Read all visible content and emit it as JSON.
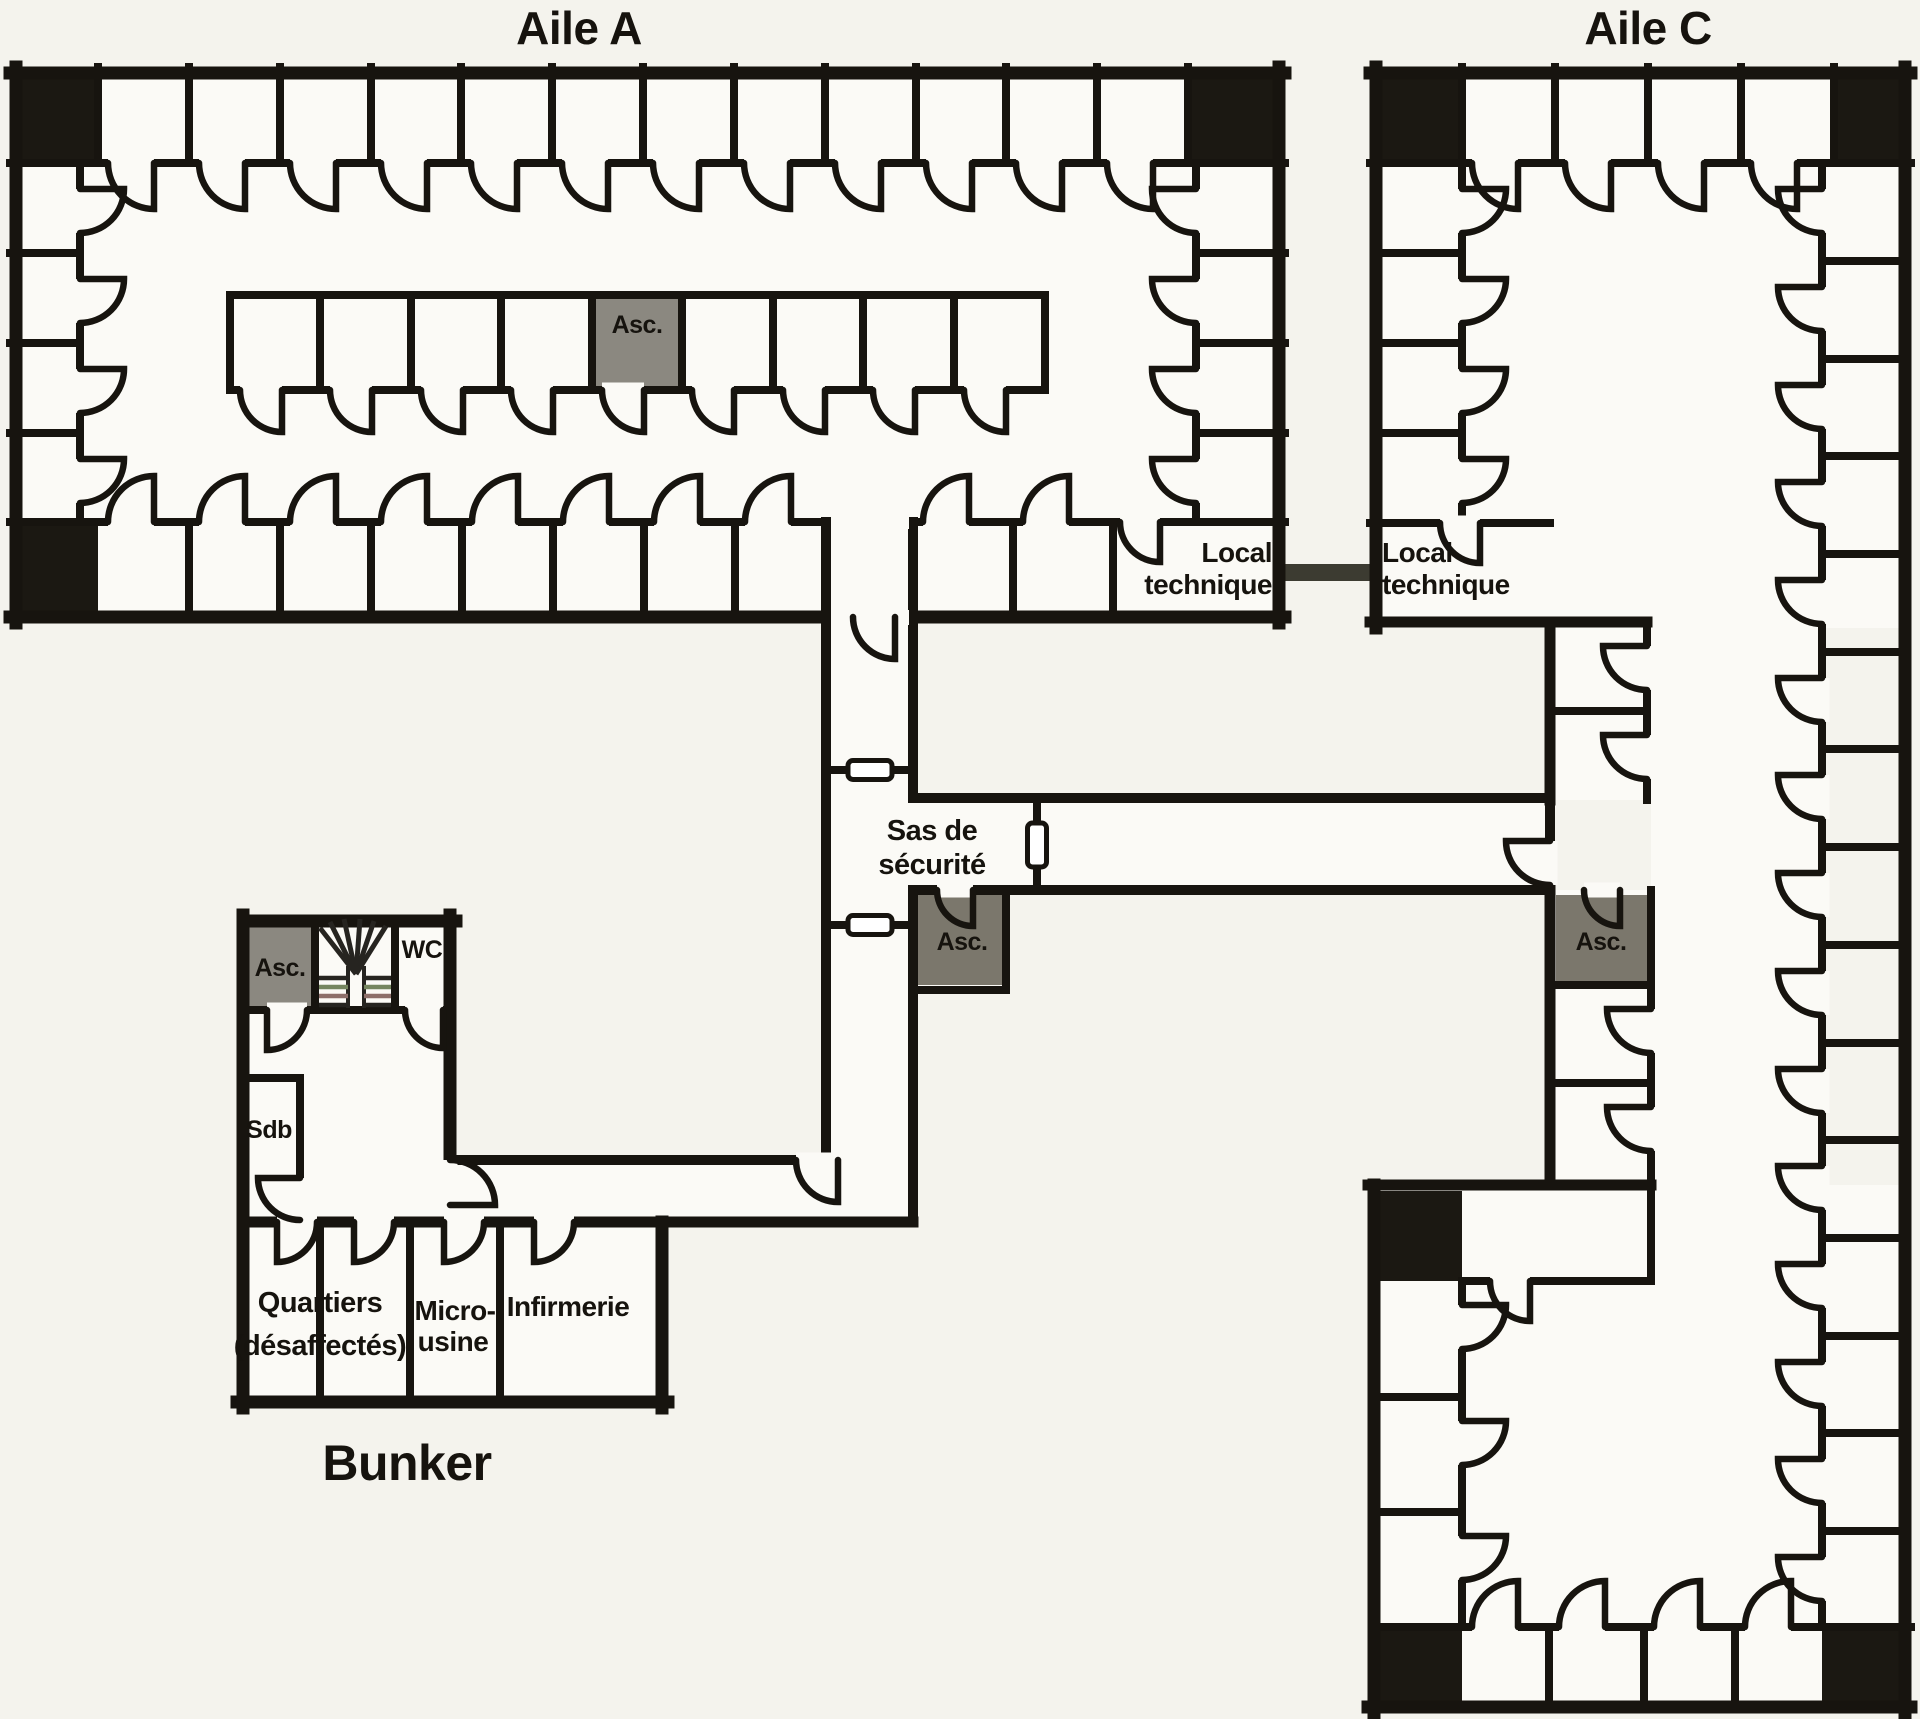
{
  "labels": {
    "aile_a": "Aile A",
    "aile_c": "Aile C",
    "bunker": "Bunker",
    "asc": "Asc.",
    "wc": "WC",
    "sdb": "Sdb",
    "local_line1": "Local",
    "local_line2": "technique",
    "sas_line1": "Sas de",
    "sas_line2": "sécurité",
    "quartiers_line1": "Quartiers",
    "quartiers_line2": "(désaffectés)",
    "micro_line1": "Micro-",
    "micro_line2": "usine",
    "infirmerie": "Infirmerie"
  },
  "colors": {
    "paper": "#f4f3ed",
    "room": "#fbfaf6",
    "wall": "#17140f",
    "corner": "#1b1812",
    "elevator_cell": "#8b8880",
    "elevator_cell_dark": "#7b776c",
    "tunnel": "#3c3b31",
    "stair": "#262420",
    "stair_green": "#75855f",
    "stair_red": "#8d6f6a",
    "text": "#16130e"
  }
}
